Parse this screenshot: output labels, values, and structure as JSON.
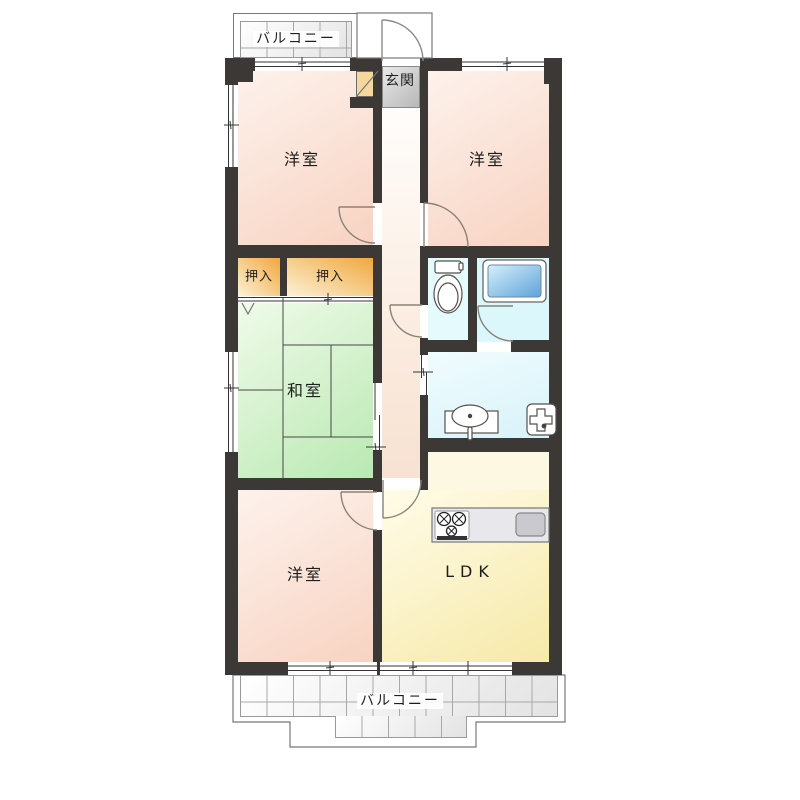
{
  "floorplan": {
    "type": "apartment-floor-plan",
    "rooms": {
      "balcony_top": {
        "label": "バルコニー"
      },
      "entrance": {
        "label": "玄関"
      },
      "bedroom_top_left": {
        "label": "洋室"
      },
      "bedroom_top_right": {
        "label": "洋室"
      },
      "closet_left": {
        "label": "押入"
      },
      "closet_right": {
        "label": "押入"
      },
      "japanese_room": {
        "label": "和室"
      },
      "bedroom_bottom_left": {
        "label": "洋室"
      },
      "ldk": {
        "label": "LDK"
      },
      "balcony_bottom": {
        "label": "バルコニー"
      }
    },
    "fixtures": {
      "toilet": "toilet-icon",
      "bathtub": "bathtub-icon",
      "washbasin": "washbasin-icon",
      "washing_machine_pan": "washing-machine-pan-icon",
      "stove": "stove-icon",
      "kitchen_sink": "kitchen-sink-icon",
      "shoe_cabinet": "shoe-cabinet-icon"
    },
    "colors": {
      "wall": "#3b3836",
      "bedroom": "#f8d3c2",
      "japanese_room": "#b9e9b2",
      "closet": "#efa83e",
      "ldk": "#f6e9a8",
      "water_area": "#dbf7fb",
      "bathtub": "#5ea3d8",
      "genkan_tile": "#b7b7b7",
      "balcony_tile": "#e3e3e3"
    }
  }
}
